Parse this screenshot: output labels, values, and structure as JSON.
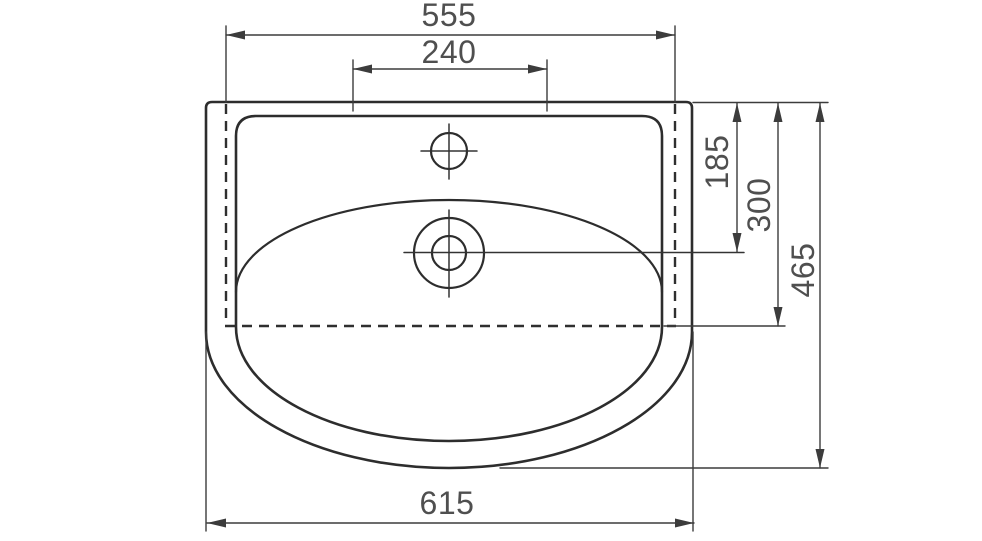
{
  "colors": {
    "background": "#ffffff",
    "outline": "#2d2d2d",
    "dimension_lines": "#3c3c3c",
    "dimension_text": "#4f4f4f"
  },
  "drawing": {
    "type": "technical-drawing-top-view",
    "subject": "washbasin",
    "dimensions": {
      "overall_width": {
        "label": "555"
      },
      "faucet_deck_width": {
        "label": "240"
      },
      "max_width": {
        "label": "615"
      },
      "drain_center_depth": {
        "label": "185"
      },
      "hidden_edge_depth": {
        "label": "300"
      },
      "overall_depth": {
        "label": "465"
      }
    }
  }
}
